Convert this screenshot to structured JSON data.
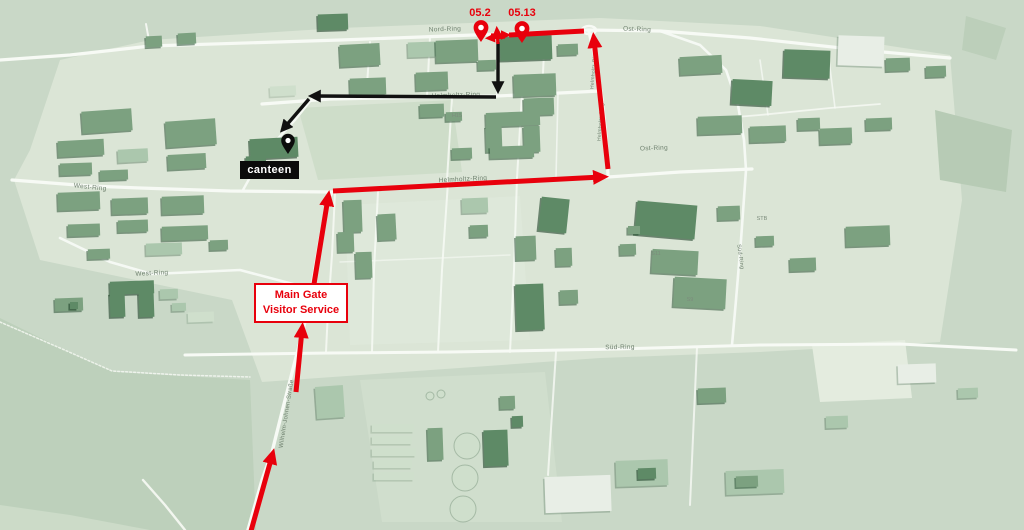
{
  "colors": {
    "bg": "#c9d8c7",
    "campus": "#dbe5d6",
    "road": "#f7faf5",
    "route_red": "#e8000c",
    "route_black": "#111111",
    "building_mid": "#7ca180",
    "building_dark": "#5e8a66",
    "building_light": "#abc7ad",
    "building_white": "#e8eee6",
    "building_pale": "#cfdfcc"
  },
  "pins": {
    "dest1": {
      "label": "05.2",
      "x": 481,
      "y": 42,
      "color": "#e8000c",
      "label_x": 480,
      "label_y": 16
    },
    "dest2": {
      "label": "05.13",
      "x": 522,
      "y": 43,
      "color": "#e8000c",
      "label_x": 522,
      "label_y": 16
    },
    "canteen": {
      "x": 288,
      "y": 154,
      "color": "#0b0b0b"
    }
  },
  "boxes": {
    "canteen": {
      "label": "canteen"
    },
    "main_gate": {
      "line1": "Main Gate",
      "line2": "Visitor Service"
    }
  },
  "street_labels": [
    {
      "t": "Nord-Ring",
      "x": 445,
      "y": 31,
      "r": -2,
      "s": 6.5
    },
    {
      "t": "Ost-Ring",
      "x": 637,
      "y": 31,
      "r": 2,
      "s": 6.5
    },
    {
      "t": "Ost-Ring",
      "x": 654,
      "y": 150,
      "r": -2,
      "s": 6.5
    },
    {
      "t": "Helmholtz-Ring",
      "x": 456,
      "y": 97,
      "r": -2,
      "s": 6.5
    },
    {
      "t": "Helmholtz-Ring",
      "x": 463,
      "y": 181,
      "r": -3,
      "s": 6.5
    },
    {
      "t": "Helmholtz-Ring",
      "x": 595,
      "y": 70,
      "r": -85,
      "s": 5
    },
    {
      "t": "Helmholtz-Ring",
      "x": 602,
      "y": 122,
      "r": -85,
      "s": 5
    },
    {
      "t": "West-Ring",
      "x": 90,
      "y": 189,
      "r": 6,
      "s": 6.5
    },
    {
      "t": "West-Ring",
      "x": 152,
      "y": 275,
      "r": -3,
      "s": 6.5
    },
    {
      "t": "Süd-Ring",
      "x": 620,
      "y": 349,
      "r": -1,
      "s": 6.5
    },
    {
      "t": "Süd-Ring",
      "x": 739,
      "y": 257,
      "r": 82,
      "s": 5.5
    },
    {
      "t": "Wilhelm-Johnen-Straße",
      "x": 288,
      "y": 414,
      "r": -81,
      "s": 6
    }
  ],
  "code_labels": [
    {
      "t": "H15",
      "x": 457,
      "y": 117
    },
    {
      "t": "STB",
      "x": 762,
      "y": 220
    },
    {
      "t": "S11",
      "x": 656,
      "y": 255
    },
    {
      "t": "S9",
      "x": 690,
      "y": 301
    }
  ],
  "patches": [
    {
      "pts": "30,150 60,60 150,40 340,28 600,18 760,26 950,55 962,200 940,342 760,352 600,358 262,382 232,300 40,260 14,180",
      "fill": "#dbe5d6",
      "op": 1
    },
    {
      "pts": "0,318 55,345 115,372 250,380 256,530 0,530",
      "fill": "#bdd0bb",
      "op": 1
    },
    {
      "pts": "0,505 70,515 150,530 0,530",
      "fill": "#ccdbc8",
      "op": 1
    },
    {
      "pts": "298,108 452,100 462,172 318,180",
      "fill": "#ccdcc8",
      "op": 0.9
    },
    {
      "pts": "345,205 520,196 530,340 350,345",
      "fill": "#e0e9db",
      "op": 0.7
    },
    {
      "pts": "360,380 545,372 562,522 382,522",
      "fill": "#d6e2d1",
      "op": 0.6
    },
    {
      "pts": "935,110 1012,130 1006,192 940,180",
      "fill": "#b7cbb5",
      "op": 1
    },
    {
      "pts": "966,16 1006,28 996,60 962,50",
      "fill": "#bccfba",
      "op": 1
    },
    {
      "pts": "812,345 905,340 912,398 820,402",
      "fill": "#e4ecdf",
      "op": 1
    }
  ],
  "roads": [
    {
      "pts": "150,46 340,40 500,34 588,30 660,31 750,38 860,50 950,58",
      "w": 3.2,
      "op": 1
    },
    {
      "pts": "0,60 70,55 150,46",
      "w": 3.2,
      "op": 1
    },
    {
      "pts": "150,46 146,24",
      "w": 2,
      "op": 0.9
    },
    {
      "pts": "262,104 330,99 497,96 560,93 600,91",
      "w": 3.2,
      "op": 1
    },
    {
      "pts": "589,32 596,62 602,98 606,135 608,176",
      "w": 3.2,
      "op": 1
    },
    {
      "pts": "12,180 90,186 140,188 230,191 332,192 450,185 608,177",
      "w": 3.2,
      "op": 1
    },
    {
      "pts": "608,177 680,172 752,169",
      "w": 3.2,
      "op": 1
    },
    {
      "pts": "248,530 262,480 272,452 283,408 294,365 303,331 312,286 320,240 328,198 332,193",
      "w": 3.4,
      "op": 1
    },
    {
      "pts": "185,355 330,353 450,352 618,349 760,345 900,344 1016,350",
      "w": 3,
      "op": 1
    },
    {
      "pts": "660,31 700,45 726,70 738,105 744,140 746,170 741,240 736,300 732,345",
      "w": 2.6,
      "op": 0.95
    },
    {
      "pts": "60,238 110,262 152,274 240,270 308,288",
      "w": 2.6,
      "op": 0.95
    },
    {
      "pts": "315,95 295,120 272,145 258,163 243,190",
      "w": 2.4,
      "op": 0.95
    },
    {
      "pts": "0,322 60,348 112,371 180,375 250,377",
      "w": 1.5,
      "op": 0.8,
      "dash": "2 2"
    },
    {
      "pts": "500,36 497,96",
      "w": 2,
      "op": 0.85
    },
    {
      "pts": "545,33 542,92",
      "w": 2,
      "op": 0.85
    },
    {
      "pts": "430,37 427,96",
      "w": 2,
      "op": 0.85
    },
    {
      "pts": "370,42 366,99",
      "w": 2,
      "op": 0.85
    },
    {
      "pts": "452,98 447,180",
      "w": 2,
      "op": 0.85
    },
    {
      "pts": "522,94 517,178",
      "w": 2,
      "op": 0.85
    },
    {
      "pts": "558,93 556,178",
      "w": 1.6,
      "op": 0.75
    },
    {
      "pts": "335,193 332,255 328,310 326,352",
      "w": 2,
      "op": 0.85
    },
    {
      "pts": "378,192 374,270 372,352",
      "w": 2,
      "op": 0.85
    },
    {
      "pts": "448,182 442,270 438,352",
      "w": 2,
      "op": 0.85
    },
    {
      "pts": "517,178 514,270 510,352",
      "w": 2,
      "op": 0.85
    },
    {
      "pts": "700,120 760,115 830,108 880,104",
      "w": 1.8,
      "op": 0.8
    },
    {
      "pts": "760,60 768,115",
      "w": 1.6,
      "op": 0.75
    },
    {
      "pts": "828,52 835,108",
      "w": 1.6,
      "op": 0.75
    },
    {
      "pts": "556,352 548,475",
      "w": 2,
      "op": 0.8
    },
    {
      "pts": "697,347 690,505",
      "w": 2,
      "op": 0.8
    },
    {
      "pts": "143,480 165,505 185,530",
      "w": 2.4,
      "op": 0.9
    },
    {
      "pts": "340,262 440,258 510,255",
      "w": 1.5,
      "op": 0.6
    }
  ],
  "roundabout": {
    "cx": 589,
    "cy": 30,
    "rx": 7,
    "ry": 4
  },
  "buildings": [
    [
      146,
      36,
      16,
      11,
      0,
      -3
    ],
    [
      178,
      33,
      18,
      11,
      0,
      -3
    ],
    [
      318,
      14,
      30,
      16,
      1,
      -2
    ],
    [
      82,
      110,
      50,
      22,
      0,
      -4
    ],
    [
      166,
      120,
      50,
      26,
      0,
      -4
    ],
    [
      58,
      140,
      46,
      16,
      0,
      -3
    ],
    [
      118,
      149,
      30,
      13,
      2,
      -3
    ],
    [
      168,
      154,
      38,
      15,
      0,
      -3
    ],
    [
      60,
      163,
      32,
      12,
      0,
      -2
    ],
    [
      100,
      170,
      28,
      10,
      0,
      -2
    ],
    [
      58,
      192,
      42,
      18,
      0,
      -2
    ],
    [
      112,
      198,
      36,
      16,
      0,
      -2
    ],
    [
      162,
      196,
      42,
      18,
      0,
      -2
    ],
    [
      118,
      220,
      30,
      12,
      0,
      -2
    ],
    [
      162,
      226,
      46,
      14,
      0,
      -2
    ],
    [
      68,
      224,
      32,
      12,
      0,
      -2
    ],
    [
      146,
      243,
      36,
      12,
      2,
      -2
    ],
    [
      88,
      249,
      22,
      10,
      0,
      -2
    ],
    [
      210,
      240,
      18,
      10,
      0,
      -2
    ],
    [
      110,
      281,
      44,
      13,
      1,
      -2
    ],
    [
      110,
      293,
      15,
      24,
      1,
      -2
    ],
    [
      139,
      293,
      15,
      24,
      1,
      -2
    ],
    [
      55,
      298,
      28,
      13,
      0,
      -2
    ],
    [
      70,
      302,
      8,
      7,
      1,
      0
    ],
    [
      160,
      289,
      18,
      10,
      2,
      -2
    ],
    [
      172,
      303,
      14,
      8,
      2,
      -2
    ],
    [
      188,
      312,
      26,
      10,
      4,
      -2
    ],
    [
      250,
      138,
      48,
      20,
      1,
      -3
    ],
    [
      246,
      156,
      20,
      10,
      1,
      -3
    ],
    [
      270,
      86,
      26,
      10,
      4,
      -3
    ],
    [
      340,
      44,
      40,
      22,
      0,
      -3
    ],
    [
      350,
      78,
      36,
      17,
      0,
      -2
    ],
    [
      408,
      42,
      28,
      15,
      2,
      -2
    ],
    [
      416,
      72,
      32,
      18,
      0,
      -2
    ],
    [
      436,
      40,
      42,
      22,
      0,
      -2
    ],
    [
      500,
      36,
      52,
      24,
      1,
      -2
    ],
    [
      558,
      44,
      20,
      11,
      0,
      -2
    ],
    [
      478,
      60,
      18,
      10,
      0,
      -2
    ],
    [
      514,
      74,
      42,
      22,
      0,
      -2
    ],
    [
      524,
      98,
      30,
      17,
      0,
      -2
    ],
    [
      420,
      104,
      24,
      13,
      0,
      -2
    ],
    [
      446,
      112,
      16,
      9,
      0,
      -2
    ],
    [
      486,
      112,
      54,
      14,
      0,
      -2
    ],
    [
      486,
      126,
      16,
      26,
      0,
      -2
    ],
    [
      524,
      126,
      16,
      26,
      0,
      -2
    ],
    [
      490,
      146,
      44,
      12,
      0,
      -2
    ],
    [
      452,
      148,
      20,
      11,
      0,
      -2
    ],
    [
      344,
      200,
      18,
      32,
      0,
      -2
    ],
    [
      378,
      214,
      18,
      26,
      0,
      -3
    ],
    [
      338,
      232,
      16,
      20,
      0,
      -2
    ],
    [
      356,
      252,
      16,
      26,
      0,
      -2
    ],
    [
      462,
      198,
      26,
      15,
      2,
      -2
    ],
    [
      470,
      225,
      18,
      12,
      0,
      -2
    ],
    [
      540,
      198,
      28,
      34,
      1,
      6
    ],
    [
      516,
      236,
      20,
      24,
      0,
      -2
    ],
    [
      556,
      248,
      16,
      18,
      0,
      -2
    ],
    [
      516,
      284,
      28,
      46,
      1,
      -2
    ],
    [
      560,
      290,
      18,
      14,
      0,
      -2
    ],
    [
      636,
      203,
      60,
      34,
      1,
      5
    ],
    [
      620,
      244,
      16,
      11,
      0,
      -2
    ],
    [
      652,
      250,
      46,
      24,
      0,
      3
    ],
    [
      674,
      278,
      52,
      30,
      0,
      3
    ],
    [
      628,
      226,
      12,
      8,
      0,
      0
    ],
    [
      718,
      206,
      22,
      14,
      0,
      -2
    ],
    [
      756,
      236,
      18,
      10,
      0,
      -2
    ],
    [
      846,
      226,
      44,
      20,
      0,
      -2
    ],
    [
      790,
      258,
      26,
      13,
      0,
      -2
    ],
    [
      680,
      56,
      42,
      18,
      0,
      -3
    ],
    [
      732,
      80,
      40,
      25,
      1,
      3
    ],
    [
      784,
      50,
      46,
      28,
      1,
      2
    ],
    [
      838,
      36,
      46,
      30,
      3,
      2
    ],
    [
      886,
      58,
      24,
      13,
      0,
      -2
    ],
    [
      698,
      116,
      44,
      18,
      0,
      -2
    ],
    [
      750,
      126,
      36,
      16,
      0,
      -2
    ],
    [
      798,
      118,
      22,
      12,
      0,
      -2
    ],
    [
      820,
      128,
      32,
      16,
      0,
      -2
    ],
    [
      866,
      118,
      26,
      12,
      0,
      -2
    ],
    [
      926,
      66,
      20,
      11,
      0,
      -2
    ],
    [
      316,
      386,
      28,
      32,
      2,
      -4
    ],
    [
      372,
      424,
      42,
      8,
      4,
      0
    ],
    [
      372,
      436,
      40,
      8,
      4,
      0
    ],
    [
      372,
      448,
      44,
      8,
      4,
      0
    ],
    [
      374,
      460,
      38,
      8,
      4,
      0
    ],
    [
      374,
      472,
      40,
      8,
      4,
      0
    ],
    [
      484,
      430,
      24,
      36,
      1,
      -2
    ],
    [
      428,
      428,
      15,
      32,
      0,
      -2
    ],
    [
      500,
      396,
      15,
      13,
      0,
      -2
    ],
    [
      512,
      416,
      11,
      11,
      1,
      -2
    ],
    [
      545,
      476,
      66,
      36,
      3,
      -2
    ],
    [
      616,
      460,
      52,
      26,
      2,
      -2
    ],
    [
      638,
      468,
      18,
      11,
      1,
      -2
    ],
    [
      698,
      388,
      28,
      15,
      0,
      -2
    ],
    [
      726,
      470,
      58,
      24,
      2,
      -2
    ],
    [
      736,
      476,
      22,
      11,
      0,
      -2
    ],
    [
      898,
      364,
      38,
      19,
      3,
      -2
    ],
    [
      826,
      416,
      22,
      12,
      2,
      -2
    ],
    [
      958,
      388,
      20,
      10,
      2,
      -2
    ]
  ],
  "tanks": [
    {
      "cx": 467,
      "cy": 446,
      "r": 13
    },
    {
      "cx": 465,
      "cy": 478,
      "r": 13
    },
    {
      "cx": 463,
      "cy": 509,
      "r": 13
    },
    {
      "cx": 430,
      "cy": 396,
      "r": 4
    },
    {
      "cx": 441,
      "cy": 394,
      "r": 4
    }
  ],
  "routes": {
    "red": {
      "width": 5,
      "segments": [
        {
          "x1": 251,
          "y1": 531,
          "x2": 272,
          "y2": 456,
          "arrow": true
        },
        {
          "x1": 296,
          "y1": 392,
          "x2": 302,
          "y2": 330,
          "arrow": true
        },
        {
          "x1": 314,
          "y1": 284,
          "x2": 328,
          "y2": 198,
          "arrow": true
        },
        {
          "x1": 333,
          "y1": 191,
          "x2": 601,
          "y2": 177,
          "arrow": true
        },
        {
          "x1": 608,
          "y1": 169,
          "x2": 594,
          "y2": 40,
          "arrow": true
        },
        {
          "x1": 584,
          "y1": 31,
          "x2": 509,
          "y2": 35,
          "arrow": false
        },
        {
          "x1": 505,
          "y1": 37,
          "x2": 490,
          "y2": 38,
          "arrow": true,
          "w": 3.2
        },
        {
          "x1": 491,
          "y1": 35,
          "x2": 506,
          "y2": 35,
          "arrow": true,
          "w": 3.2
        },
        {
          "x1": 498,
          "y1": 44,
          "x2": 497,
          "y2": 31,
          "arrow": true,
          "w": 3.2
        }
      ]
    },
    "black": {
      "width": 3.4,
      "segments": [
        {
          "x1": 498,
          "y1": 42,
          "x2": 498,
          "y2": 88,
          "arrow": true
        },
        {
          "x1": 496,
          "y1": 97,
          "x2": 314,
          "y2": 96,
          "arrow": true
        },
        {
          "x1": 309,
          "y1": 99,
          "x2": 284,
          "y2": 128,
          "arrow": true
        }
      ]
    }
  }
}
